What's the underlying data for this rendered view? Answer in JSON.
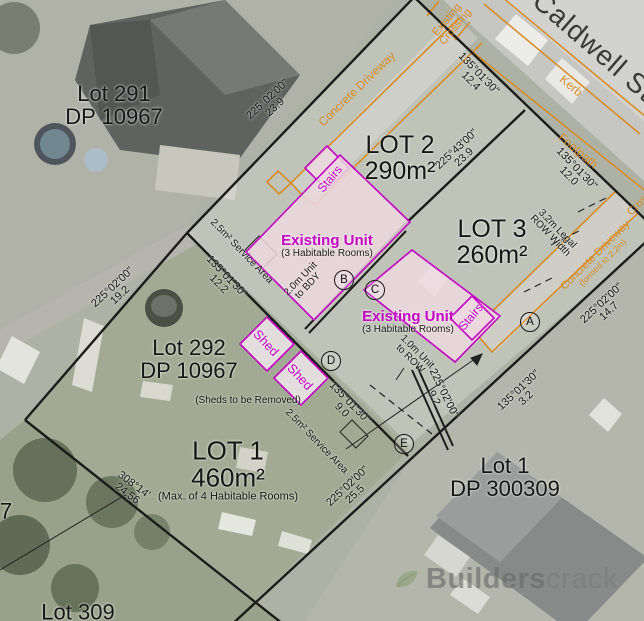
{
  "colors": {
    "boundary": "#1c1c1c",
    "magenta": "#c400c4",
    "orange": "#d98c28",
    "pink_fill": "#ecd8de",
    "street_text": "#3a3a3a",
    "watermark_gray": "#757575"
  },
  "street": {
    "name": "Caldwell St",
    "kerb": "Kerb",
    "footpath": "Footpath",
    "crossing_line1": "Existing",
    "crossing_line2": "Crossing",
    "crossing_right": "Crossing",
    "driveway_top": "Concrete Driveway",
    "driveway_right": "Concrete Driveway",
    "driveway_right_note": "(formed to 2.2m)"
  },
  "lots": {
    "lot291": {
      "title": "Lot 291",
      "subtitle": "DP 10967"
    },
    "lot2": {
      "title": "LOT 2",
      "area": "290m²"
    },
    "lot3": {
      "title": "LOT 3",
      "area": "260m²"
    },
    "lot292": {
      "title": "Lot 292",
      "subtitle": "DP 10967"
    },
    "lot1_new": {
      "title": "LOT 1",
      "area": "460m²",
      "note": "(Max. of 4 Habitable Rooms)"
    },
    "lot1_existing": {
      "title": "Lot 1",
      "subtitle": "DP 300309"
    },
    "lot309": {
      "title": "Lot 309"
    },
    "edge_partial": "7"
  },
  "dims": {
    "nw_main": {
      "bearing": "225°02'00\"",
      "distance": "23.9"
    },
    "frontage_lot2": {
      "bearing": "135°01'30\"",
      "distance": "12.4"
    },
    "lot2_lot3": {
      "bearing": "225°43'00\"",
      "distance": "23.9"
    },
    "frontage_row": {
      "bearing": "135°01'30\"",
      "distance": "12.0"
    },
    "row_width": {
      "line1": "3.2m Legal",
      "line2": "ROW Width"
    },
    "se_lot3": {
      "bearing": "225°02'00\"",
      "distance": "14.7"
    },
    "se_short": {
      "bearing": "135°01'30\"",
      "distance": "3.2"
    },
    "lot1_nw": {
      "bearing": "135°01'30\"",
      "distance": "12.2"
    },
    "west": {
      "bearing": "225°02'00\"",
      "distance": "19.2"
    },
    "lot1_ne": {
      "bearing": "135°01'30\"",
      "distance": "9.0"
    },
    "row_end": {
      "bearing": "225°02'00\"",
      "distance": "9.2"
    },
    "south": {
      "bearing": "308°14'",
      "distance": "24.56"
    },
    "se_lot1": {
      "bearing": "225°02'00\"",
      "distance": "25.5"
    }
  },
  "annotations": {
    "service_area_upper": "2.5m² Service Area",
    "service_area_lower": "2.5m² Service Area",
    "unit_to_bdy_line1": "2.0m Unit",
    "unit_to_bdy_line2": "to BDY",
    "unit_to_row_line1": "1.0m Unit",
    "unit_to_row_line2": "to ROW",
    "sheds_removed": "(Sheds to be Removed)"
  },
  "buildings": {
    "unit1": {
      "name": "Existing Unit",
      "note": "(3 Habitable Rooms)"
    },
    "unit2": {
      "name": "Existing Unit",
      "note": "(3 Habitable Rooms)"
    },
    "stairs1": "Stairs",
    "stairs2": "Stairs",
    "shed1": "Shed",
    "shed2": "Shed"
  },
  "markers": {
    "a": "A",
    "b": "B",
    "c": "C",
    "d": "D",
    "e": "E"
  },
  "watermark": {
    "bold": "Builders",
    "regular": "crack"
  }
}
